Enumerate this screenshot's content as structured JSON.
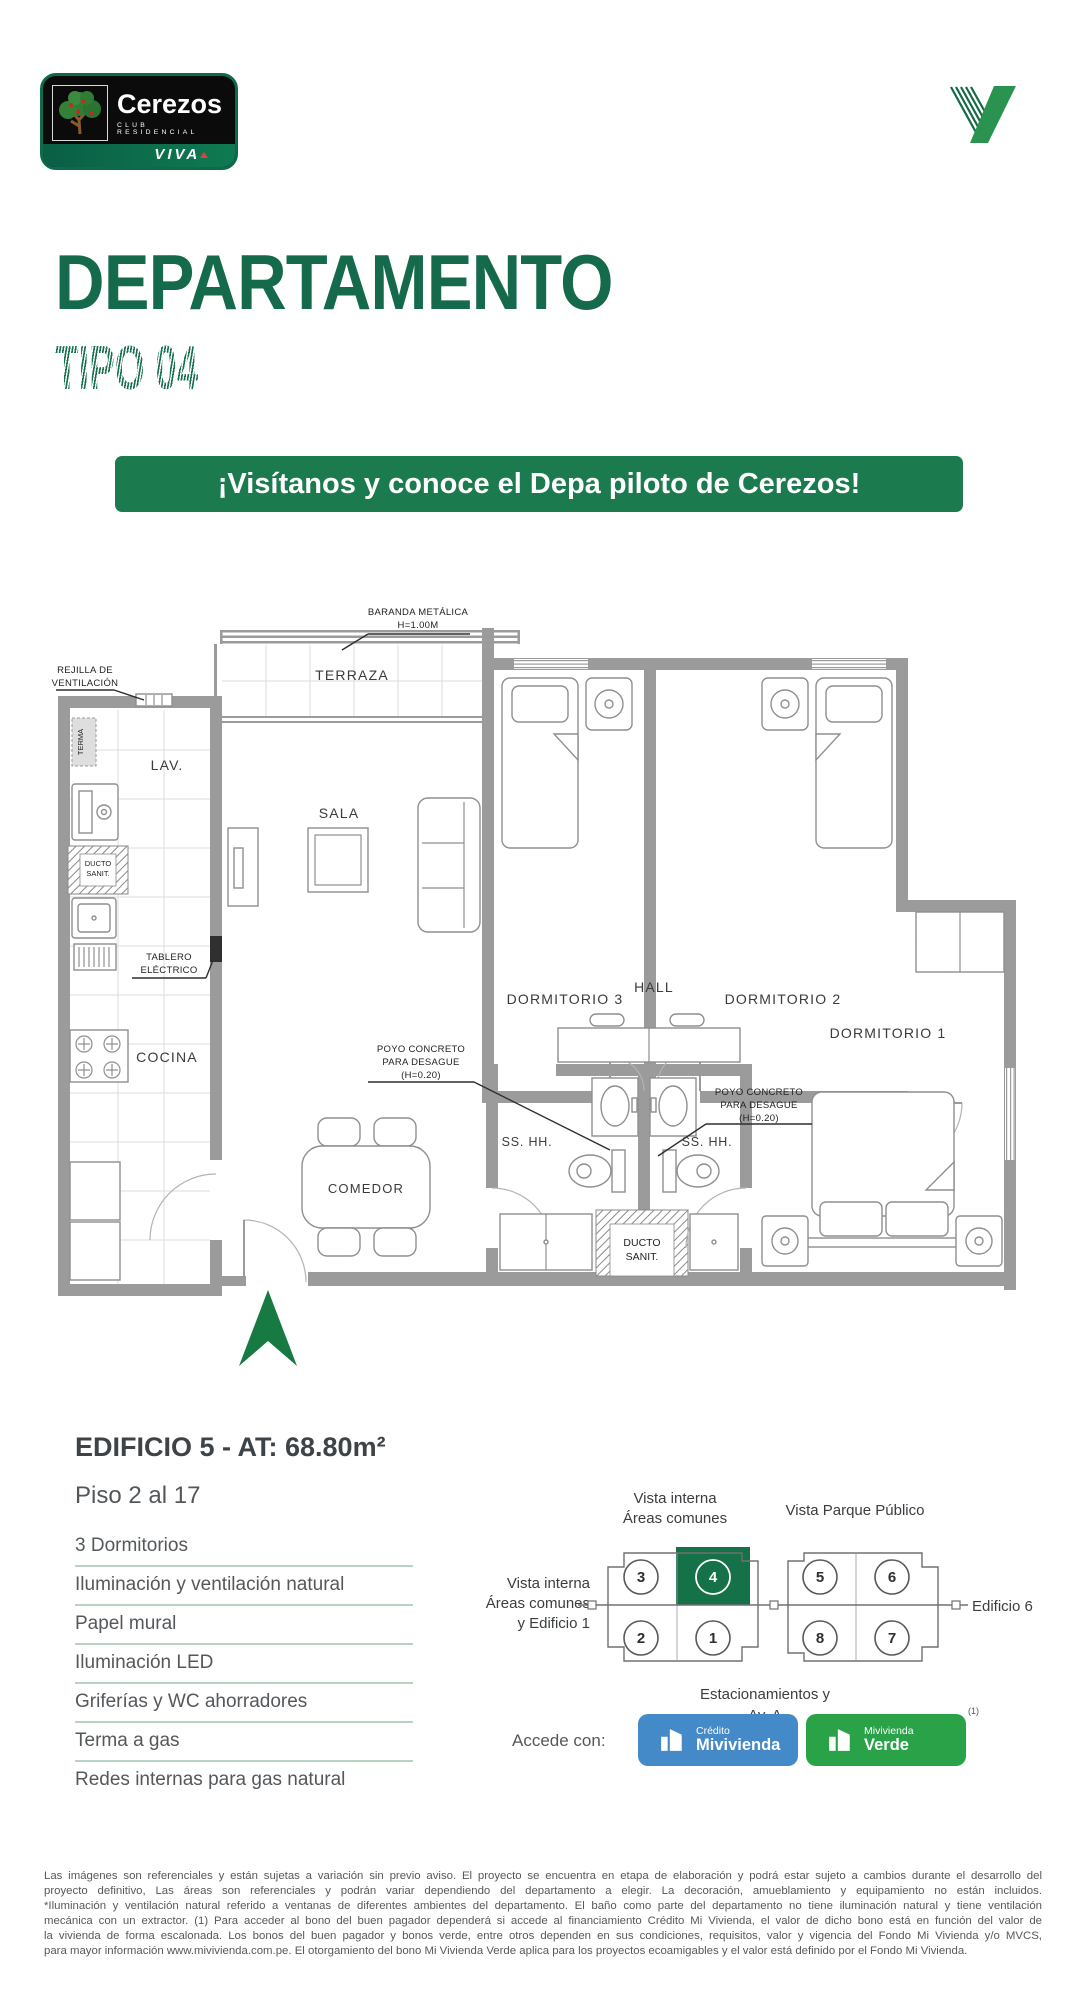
{
  "colors": {
    "brand_green": "#156a4b",
    "banner_green": "#1b7a4e",
    "keyplan_green": "#157148",
    "arrow_green": "#187a43",
    "credito_blue": "#4489c8",
    "verde_green": "#2aa348",
    "wall_gray": "#9b9b9c",
    "divider_green": "#b9d3c2"
  },
  "logo": {
    "name": "Cerezos",
    "subtitle": "CLUB RESIDENCIAL",
    "viva": "VIVA"
  },
  "header": {
    "title": "DEPARTAMENTO",
    "subtitle": "TIPO 04"
  },
  "banner": {
    "text": "¡Visítanos y conoce el Depa piloto de Cerezos!"
  },
  "floorplan": {
    "rooms": {
      "terraza": "TERRAZA",
      "lav": "LAV.",
      "sala": "SALA",
      "dormitorio3": "DORMITORIO 3",
      "dormitorio2": "DORMITORIO 2",
      "dormitorio1": "DORMITORIO 1",
      "hall": "HALL",
      "cocina": "COCINA",
      "comedor": "COMEDOR",
      "sshh_left": "SS. HH.",
      "sshh_right": "SS. HH."
    },
    "annotations": {
      "baranda_l1": "BARANDA METÁLICA",
      "baranda_l2": "H=1.00M",
      "rejilla_l1": "REJILLA DE",
      "rejilla_l2": "VENTILACIÓN",
      "terma": "TERMA",
      "ducto_kitchen_l1": "DUCTO",
      "ducto_kitchen_l2": "SANIT.",
      "tablero_l1": "TABLERO",
      "tablero_l2": "ELÉCTRICO",
      "poyo_l1": "POYO CONCRETO",
      "poyo_l2": "PARA DESAGUE",
      "poyo_l3": "(H=0.20)",
      "ducto_bottom_l1": "DUCTO",
      "ducto_bottom_l2": "SANIT."
    }
  },
  "details": {
    "title": "EDIFICIO 5 - AT: 68.80m²",
    "floors": "Piso 2 al 17",
    "features": [
      "3 Dormitorios",
      "Iluminación y ventilación natural",
      "Papel mural",
      "Iluminación LED",
      "Griferías y WC ahorradores",
      "Terma a gas",
      "Redes internas para gas natural"
    ]
  },
  "keyplan": {
    "label_top_left_l1": "Vista interna",
    "label_top_left_l2": "Áreas comunes",
    "label_top_right": "Vista Parque Público",
    "label_left_l1": "Vista interna",
    "label_left_l2": "Áreas comunes",
    "label_left_l3": "y Edificio 1",
    "label_right": "Edificio 6",
    "label_bottom_l1": "Estacionamientos y",
    "label_bottom_l2": "Av. A",
    "units_top": [
      "3",
      "4",
      "5",
      "6"
    ],
    "units_bottom": [
      "2",
      "1",
      "8",
      "7"
    ],
    "highlighted_unit": "4"
  },
  "access": {
    "label": "Accede con:",
    "badge1_l1": "Crédito",
    "badge1_l2": "Mivivienda",
    "badge2_l1": "Mivivienda",
    "badge2_l2": "Verde",
    "note": "(1)"
  },
  "footer": {
    "lines": [
      "Las imágenes son referenciales y están sujetas a variación sin previo aviso. El proyecto se encuentra en etapa de elaboración y podrá estar sujeto a cambios durante el desarrollo del",
      "proyecto definitivo, Las áreas son referenciales y podrán variar dependiendo del departamento a elegir. La decoración, amueblamiento y equipamiento no están incluidos.",
      "*Iluminación y ventilación natural referido a ventanas de diferentes ambientes del departamento. El baño como parte del departamento no tiene iluminación natural y tiene ventilación",
      "mecánica con un extractor. (1) Para acceder al bono del buen pagador dependerá si accede al financiamiento Crédito Mi Vivienda, el valor de dicho bono está en función del valor de",
      "la vivienda de forma escalonada. Los bonos del buen pagador y bonos verde, entre otros dependen en sus condiciones, requisitos, valor y vigencia del Fondo Mi Vivienda y/o MVCS,",
      "para mayor información www.mivivienda.com.pe. El otorgamiento del bono Mi Vivienda Verde aplica para los proyectos ecoamigables y el valor está definido por el Fondo Mi Vivienda."
    ]
  }
}
